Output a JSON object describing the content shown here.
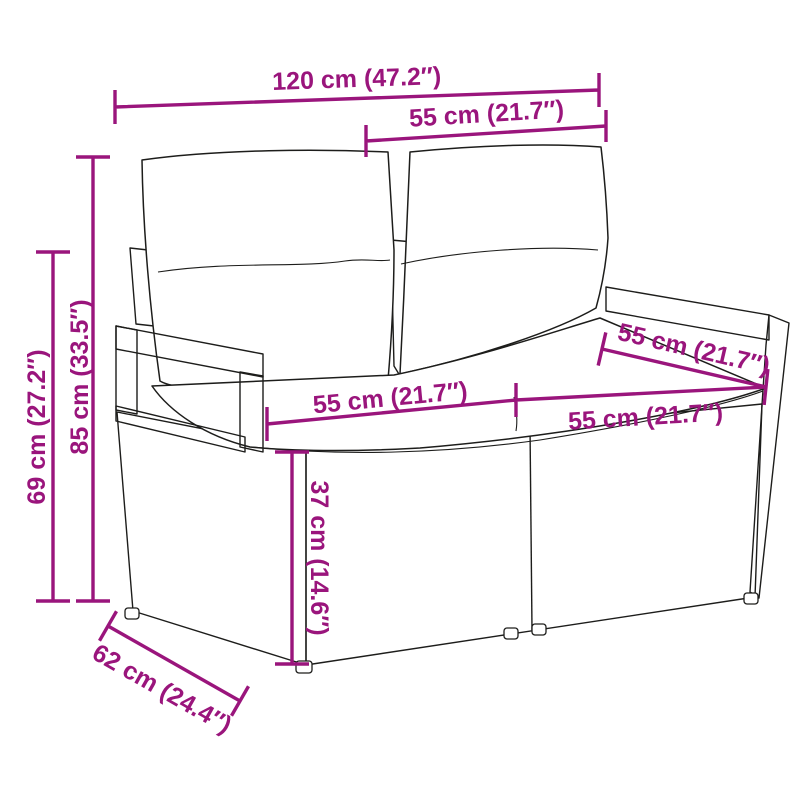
{
  "page": {
    "background": "#ffffff",
    "type": "product-dimension-diagram",
    "subject": "2-seater poly rattan garden sofa with cushions"
  },
  "style": {
    "dimension_color": "#9A157C",
    "outline_color": "#1d1d1b",
    "wicker_line_color": "#5a5a5a"
  },
  "dimensions": {
    "total_width": "120 cm (47.2″)",
    "backrest_width": "55 cm (21.7″)",
    "arm_depth": "55 cm (21.7″)",
    "seat_width_left": "55 cm (21.7″)",
    "seat_width_right": "55 cm (21.7″)",
    "seat_height": "37 cm (14.6″)",
    "armrest_height": "69 cm (27.2″)",
    "total_height": "85 cm (33.5″)",
    "base_depth": "62 cm (24.4″)"
  }
}
